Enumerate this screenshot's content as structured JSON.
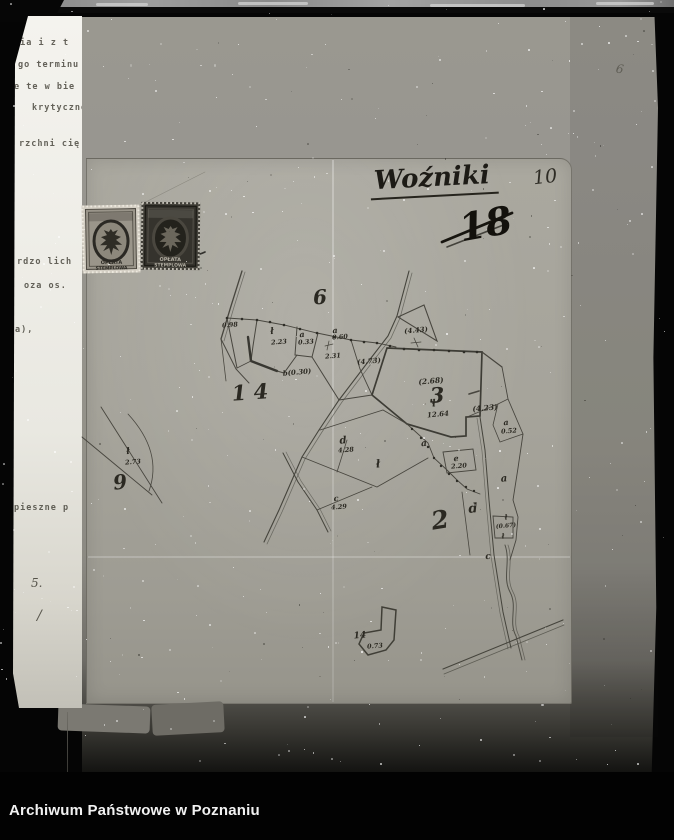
{
  "archive_bar": {
    "label": "Archiwum Państwowe w Poznaniu"
  },
  "annotations": {
    "sheet_title": "Woźniki",
    "page_number": "10",
    "crossed_out_number": "18",
    "pencil_mark": "6"
  },
  "stamps": {
    "left": {
      "line1": "OPŁATA",
      "line2": "STEMPLOWA"
    },
    "right": {
      "line1": "OPŁATA",
      "line2": "STEMPLOWA"
    }
  },
  "typed_page": {
    "lines": [
      {
        "text": "nia i z t",
        "x": 1,
        "y": 22
      },
      {
        "text": "go terminu",
        "x": 5,
        "y": 44
      },
      {
        "text": "e te w bie",
        "x": 1,
        "y": 66
      },
      {
        "text": "krytyczne",
        "x": 19,
        "y": 87
      },
      {
        "text": "rzchni cię",
        "x": 6,
        "y": 123
      },
      {
        "text": "rdzo lich",
        "x": 4,
        "y": 241
      },
      {
        "text": "oza os.",
        "x": 11,
        "y": 265
      },
      {
        "text": "a),",
        "x": 2,
        "y": 309
      },
      {
        "text": "pieszne p",
        "x": 1,
        "y": 487
      }
    ],
    "marks": [
      {
        "text": "5.",
        "x": 18,
        "y": 560,
        "size": 12
      },
      {
        "text": "/",
        "x": 24,
        "y": 592,
        "size": 14
      }
    ]
  },
  "map": {
    "labels": [
      {
        "text": "6",
        "x": 320,
        "y": 297,
        "size": 20,
        "rot": -4
      },
      {
        "text": "1 4",
        "x": 250,
        "y": 392,
        "size": 21,
        "rot": -4
      },
      {
        "text": "9",
        "x": 120,
        "y": 482,
        "size": 20,
        "rot": -7
      },
      {
        "text": "3",
        "x": 437,
        "y": 395,
        "size": 21,
        "rot": -3
      },
      {
        "text": "2",
        "x": 440,
        "y": 520,
        "size": 25,
        "rot": -9
      },
      {
        "text": "0.98",
        "x": 230,
        "y": 325,
        "size": 6.5
      },
      {
        "text": "ł",
        "x": 272,
        "y": 332,
        "size": 9
      },
      {
        "text": "2.23",
        "x": 279,
        "y": 342,
        "size": 6.5
      },
      {
        "text": "a",
        "x": 302,
        "y": 334,
        "size": 8
      },
      {
        "text": "0.33",
        "x": 306,
        "y": 342,
        "size": 6.5
      },
      {
        "text": "a",
        "x": 335,
        "y": 330,
        "size": 8
      },
      {
        "text": "0.60",
        "x": 340,
        "y": 337,
        "size": 6.5
      },
      {
        "text": "2.31",
        "x": 333,
        "y": 356,
        "size": 6.5
      },
      {
        "text": "(4.43)",
        "x": 416,
        "y": 330,
        "size": 7
      },
      {
        "text": "(4.73)",
        "x": 369,
        "y": 361,
        "size": 7
      },
      {
        "text": "b(0.30)",
        "x": 297,
        "y": 372,
        "size": 7
      },
      {
        "text": "(2.68)",
        "x": 431,
        "y": 381,
        "size": 7.5
      },
      {
        "text": "ł",
        "x": 434,
        "y": 404,
        "size": 10
      },
      {
        "text": "12.64",
        "x": 438,
        "y": 414,
        "size": 7
      },
      {
        "text": "(4.23)",
        "x": 485,
        "y": 408,
        "size": 7.5
      },
      {
        "text": "a",
        "x": 506,
        "y": 422,
        "size": 8
      },
      {
        "text": "0.52",
        "x": 509,
        "y": 431,
        "size": 6.5
      },
      {
        "text": "d",
        "x": 343,
        "y": 441,
        "size": 10
      },
      {
        "text": "4.28",
        "x": 346,
        "y": 450,
        "size": 6.5
      },
      {
        "text": "a",
        "x": 424,
        "y": 444,
        "size": 9
      },
      {
        "text": "ł",
        "x": 378,
        "y": 464,
        "size": 11
      },
      {
        "text": "e",
        "x": 456,
        "y": 458,
        "size": 8
      },
      {
        "text": "2.20",
        "x": 459,
        "y": 466,
        "size": 6.5
      },
      {
        "text": "a",
        "x": 504,
        "y": 479,
        "size": 10
      },
      {
        "text": "c",
        "x": 336,
        "y": 498,
        "size": 8
      },
      {
        "text": "4.29",
        "x": 339,
        "y": 507,
        "size": 6.5
      },
      {
        "text": "d",
        "x": 473,
        "y": 509,
        "size": 13
      },
      {
        "text": "ł",
        "x": 506,
        "y": 517,
        "size": 7
      },
      {
        "text": "(0.67)",
        "x": 506,
        "y": 526,
        "size": 6
      },
      {
        "text": "ł",
        "x": 503,
        "y": 536,
        "size": 7
      },
      {
        "text": "c",
        "x": 488,
        "y": 557,
        "size": 9
      },
      {
        "text": "ł",
        "x": 128,
        "y": 452,
        "size": 9
      },
      {
        "text": "2.73",
        "x": 133,
        "y": 462,
        "size": 6.5
      },
      {
        "text": "14",
        "x": 360,
        "y": 636,
        "size": 9
      },
      {
        "text": "0.73",
        "x": 375,
        "y": 646,
        "size": 6.5
      }
    ]
  },
  "colors": {
    "backing_paper": "#949289",
    "map_sheet": "#a6a49b",
    "typed_paper": "#efeee8",
    "ink": "#35332c",
    "bar_bg": "#020202",
    "bar_text": "#f2f2f2"
  }
}
